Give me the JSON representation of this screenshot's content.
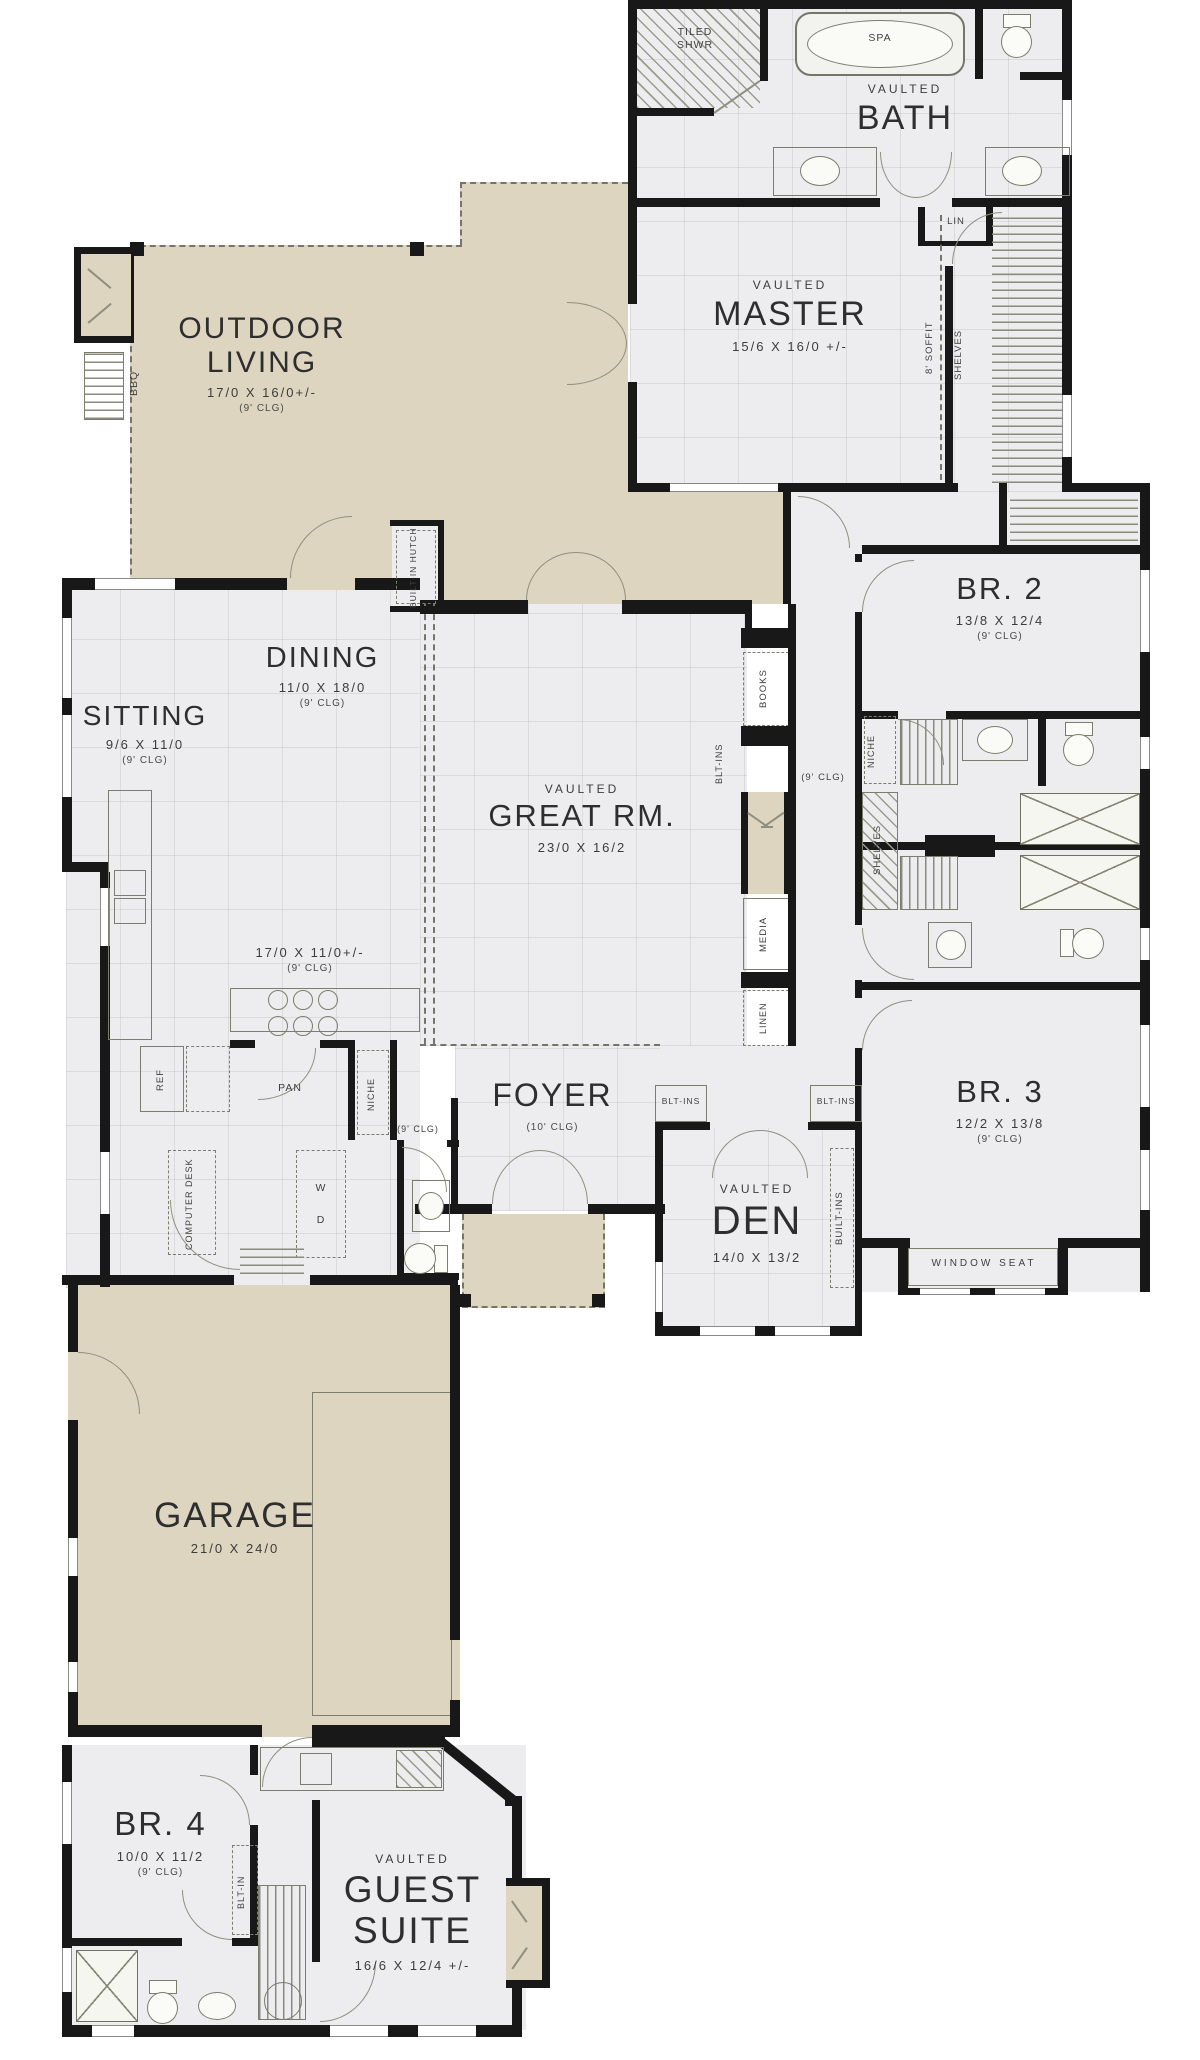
{
  "plan": {
    "rooms": {
      "outdoor": {
        "name": "OUTDOOR LIVING",
        "dims": "17/0 X 16/0+/-",
        "clg": "(9' CLG)"
      },
      "bath": {
        "pre": "VAULTED",
        "name": "BATH"
      },
      "master": {
        "pre": "VAULTED",
        "name": "MASTER",
        "dims": "15/6 X 16/0 +/-"
      },
      "br2": {
        "name": "BR. 2",
        "dims": "13/8 X 12/4",
        "clg": "(9' CLG)"
      },
      "sitting": {
        "name": "SITTING",
        "dims": "9/6 X 11/0",
        "clg": "(9' CLG)"
      },
      "dining": {
        "name": "DINING",
        "dims": "11/0 X 18/0",
        "clg": "(9' CLG)"
      },
      "great": {
        "pre": "VAULTED",
        "name": "GREAT RM.",
        "dims": "23/0 X 16/2"
      },
      "kitchen": {
        "dims": "17/0 X 11/0+/-",
        "clg": "(9' CLG)"
      },
      "foyer": {
        "name": "FOYER",
        "clg": "(10' CLG)"
      },
      "den": {
        "pre": "VAULTED",
        "name": "DEN",
        "dims": "14/0 X 13/2"
      },
      "br3": {
        "name": "BR. 3",
        "dims": "12/2 X 13/8",
        "clg": "(9' CLG)"
      },
      "garage": {
        "name": "GARAGE",
        "dims": "21/0 X 24/0"
      },
      "br4": {
        "name": "BR. 4",
        "dims": "10/0 X 11/2",
        "clg": "(9' CLG)"
      },
      "guest": {
        "pre": "VAULTED",
        "name": "GUEST SUITE",
        "dims": "16/6 X 12/4 +/-"
      }
    },
    "labels": {
      "tiled_shwr": "TILED SHWR",
      "spa": "SPA",
      "lin": "LIN",
      "soffit": "8' SOFFIT",
      "shelves": "SHELVES",
      "bbq": "BBQ",
      "hutch": "BUILT-IN HUTCH",
      "books": "BOOKS",
      "blt_ins": "BLT-INS",
      "media": "MEDIA",
      "linen": "LINEN",
      "niche": "NICHE",
      "ref": "REF",
      "pan": "PAN",
      "computer_desk": "COMPUTER DESK",
      "washer": "W",
      "dryer": "D",
      "window_seat": "WINDOW SEAT",
      "built_ins": "BUILT-INS",
      "blt_in": "BLT-IN",
      "clg9": "(9' CLG)"
    },
    "colors": {
      "wall": "#181818",
      "room": "#ededef",
      "outdoor": "#ded5c0",
      "line": "#8f8f80"
    }
  }
}
